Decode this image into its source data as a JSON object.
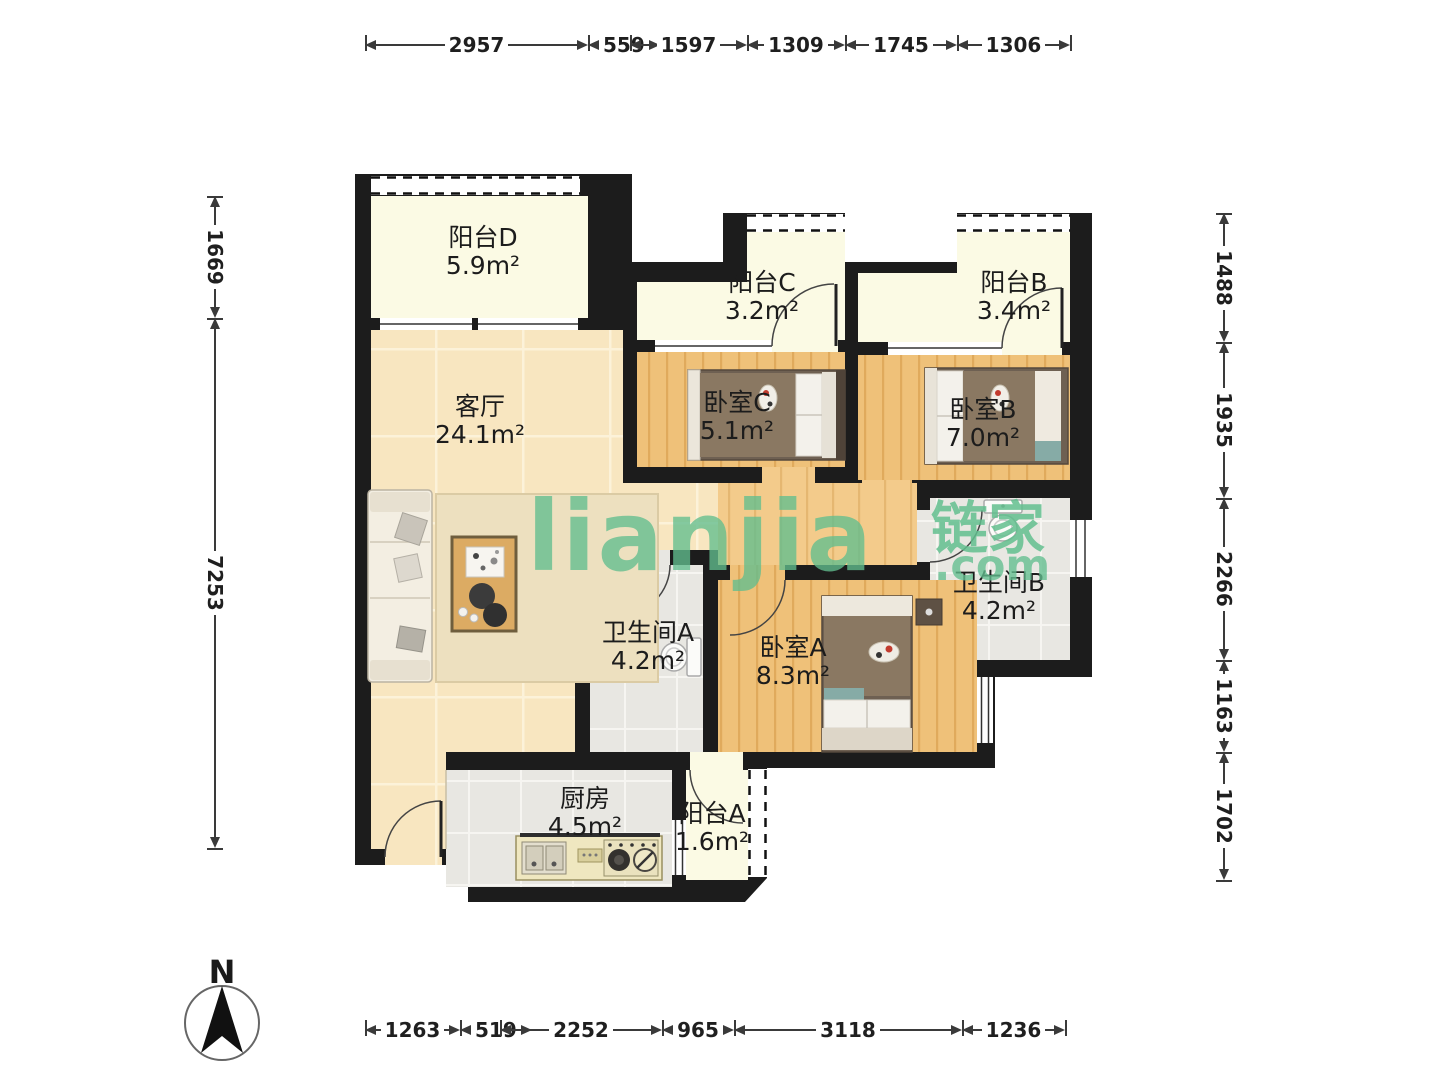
{
  "watermark": {
    "logo": "lianjia",
    "cn": "链家",
    "com": ".com",
    "color": "#61BE8E"
  },
  "compass": {
    "label": "N"
  },
  "rooms": [
    {
      "id": "balcony-d",
      "name": "阳台D",
      "area": "5.9m²"
    },
    {
      "id": "living-room",
      "name": "客厅",
      "area": "24.1m²"
    },
    {
      "id": "balcony-c",
      "name": "阳台C",
      "area": "3.2m²"
    },
    {
      "id": "balcony-b",
      "name": "阳台B",
      "area": "3.4m²"
    },
    {
      "id": "bedroom-c",
      "name": "卧室C",
      "area": "5.1m²"
    },
    {
      "id": "bedroom-b",
      "name": "卧室B",
      "area": "7.0m²"
    },
    {
      "id": "bathroom-b",
      "name": "卫生间B",
      "area": "4.2m²"
    },
    {
      "id": "bathroom-a",
      "name": "卫生间A",
      "area": "4.2m²"
    },
    {
      "id": "bedroom-a",
      "name": "卧室A",
      "area": "8.3m²"
    },
    {
      "id": "kitchen",
      "name": "厨房",
      "area": "4.5m²"
    },
    {
      "id": "balcony-a",
      "name": "阳台A",
      "area": "1.6m²"
    }
  ],
  "dimensions": {
    "top": [
      "2957",
      "559",
      "1597",
      "1309",
      "1745",
      "1306"
    ],
    "bottom": [
      "1263",
      "519",
      "2252",
      "965",
      "3118",
      "1236"
    ],
    "left": [
      "1669",
      "7253"
    ],
    "right": [
      "1488",
      "1935",
      "2266",
      "1163",
      "1702"
    ]
  },
  "colors": {
    "wall": "#1c1c1c",
    "balcony_floor": "#FBFAE4",
    "living_tile": "#F8E6C0",
    "bedroom_wood": "#EFC179",
    "hall_wood": "#F3CB8B",
    "bath_tile": "#E8E7E2",
    "watermark_green": "#61BE8E"
  }
}
